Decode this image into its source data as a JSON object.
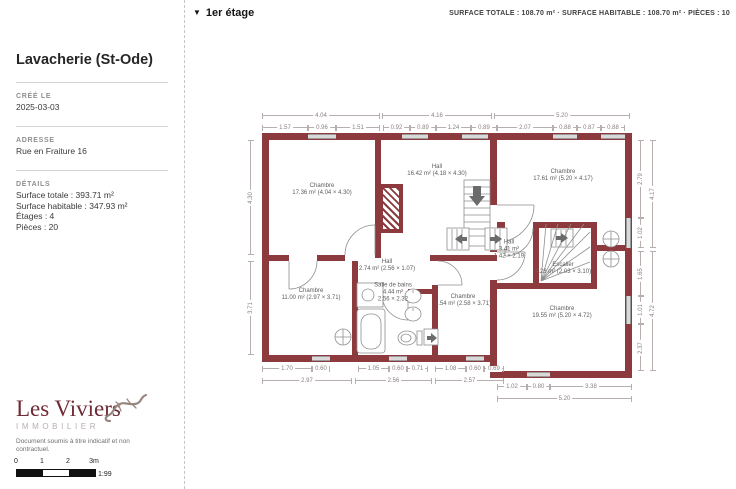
{
  "header": {
    "triangle": "▼",
    "floor_label": "1er étage",
    "surface_summary": "SURFACE TOTALE : 108.70 m² · SURFACE HABITABLE : 108.70 m² · PIÈCES : 10"
  },
  "sidebar": {
    "title": "Lavacherie (St-Ode)",
    "created_label": "CRÉÉ LE",
    "created_value": "2025-03-03",
    "address_label": "ADRESSE",
    "address_value": "Rue en Fraiture 16",
    "details_label": "DÉTAILS",
    "details": [
      "Surface totale : 393.71 m²",
      "Surface habitable : 347.93 m²",
      "Étages : 4",
      "Pièces : 20"
    ],
    "logo_title": "Les Viviers",
    "logo_subtitle": "IMMOBILIER",
    "disclaimer": "Document soumis à titre indicatif et non contractuel.",
    "scale": {
      "ticks": [
        "0",
        "1",
        "2",
        "3m"
      ],
      "ratio": "1:99"
    }
  },
  "plan": {
    "colors": {
      "wall": "#8d3a3e",
      "window": "#d9d9d9"
    },
    "rooms": [
      {
        "lines": [
          "Chambre",
          "17.36 m² (4.04 × 4.30)"
        ],
        "cx": 322,
        "cy": 190
      },
      {
        "lines": [
          "Hall",
          "16.42 m² (4.18 × 4.30)"
        ],
        "cx": 437,
        "cy": 171
      },
      {
        "lines": [
          "Chambre",
          "17.61 m² (5.20 × 4.17)"
        ],
        "cx": 563,
        "cy": 176
      },
      {
        "lines": [
          "Chambre",
          "11.00 m² (2.97 × 3.71)"
        ],
        "cx": 311,
        "cy": 295
      },
      {
        "lines": [
          "Hall",
          "2.74 m² (2.56 × 1.07)"
        ],
        "cx": 387,
        "cy": 266
      },
      {
        "lines": [
          "Salle de bains",
          "4.44 m²",
          "2.56 × 2.32"
        ],
        "cx": 393,
        "cy": 293
      },
      {
        "lines": [
          "Chambre",
          "9.54 m² (2.58 × 3.71)"
        ],
        "cx": 463,
        "cy": 301
      },
      {
        "lines": [
          "Hall",
          "3.41 m²",
          "1.42 × 2.19"
        ],
        "cx": 509,
        "cy": 250
      },
      {
        "lines": [
          "Escalier",
          "4.28 m² (2.03 × 3.10)"
        ],
        "cx": 563,
        "cy": 269
      },
      {
        "lines": [
          "Chambre",
          "19.55 m² (5.20 × 4.72)"
        ],
        "cx": 562,
        "cy": 313
      }
    ],
    "dims_h": [
      {
        "label": "4.04",
        "x": 262,
        "y": 115,
        "w": 118
      },
      {
        "label": "4.16",
        "x": 382,
        "y": 115,
        "w": 110
      },
      {
        "label": "5.20",
        "x": 494,
        "y": 115,
        "w": 136
      },
      {
        "label": "1.57",
        "x": 262,
        "y": 127,
        "w": 46
      },
      {
        "label": "0.96",
        "x": 308,
        "y": 127,
        "w": 28
      },
      {
        "label": "1.51",
        "x": 336,
        "y": 127,
        "w": 44
      },
      {
        "label": "0.92",
        "x": 383,
        "y": 127,
        "w": 27
      },
      {
        "label": "0.89",
        "x": 410,
        "y": 127,
        "w": 26
      },
      {
        "label": "1.24",
        "x": 436,
        "y": 127,
        "w": 35
      },
      {
        "label": "0.89",
        "x": 471,
        "y": 127,
        "w": 26
      },
      {
        "label": "2.07",
        "x": 497,
        "y": 127,
        "w": 56
      },
      {
        "label": "0.88",
        "x": 553,
        "y": 127,
        "w": 24
      },
      {
        "label": "0.87",
        "x": 577,
        "y": 127,
        "w": 24
      },
      {
        "label": "0.88",
        "x": 601,
        "y": 127,
        "w": 24
      },
      {
        "label": "1.70",
        "x": 262,
        "y": 368,
        "w": 50
      },
      {
        "label": "0.60",
        "x": 312,
        "y": 368,
        "w": 18
      },
      {
        "label": "1.05",
        "x": 358,
        "y": 368,
        "w": 31
      },
      {
        "label": "0.60",
        "x": 389,
        "y": 368,
        "w": 18
      },
      {
        "label": "0.71",
        "x": 407,
        "y": 368,
        "w": 21
      },
      {
        "label": "1.08",
        "x": 435,
        "y": 368,
        "w": 31
      },
      {
        "label": "0.60",
        "x": 466,
        "y": 368,
        "w": 18
      },
      {
        "label": "0.69",
        "x": 484,
        "y": 368,
        "w": 20
      },
      {
        "label": "2.97",
        "x": 262,
        "y": 380,
        "w": 90
      },
      {
        "label": "2.56",
        "x": 355,
        "y": 380,
        "w": 77
      },
      {
        "label": "2.57",
        "x": 435,
        "y": 380,
        "w": 69
      },
      {
        "label": "1.02",
        "x": 497,
        "y": 386,
        "w": 30
      },
      {
        "label": "0.80",
        "x": 527,
        "y": 386,
        "w": 23
      },
      {
        "label": "3.38",
        "x": 550,
        "y": 386,
        "w": 82
      },
      {
        "label": "5.20",
        "x": 497,
        "y": 398,
        "w": 135
      }
    ],
    "dims_v": [
      {
        "label": "4.30",
        "x": 250,
        "y": 140,
        "h": 115
      },
      {
        "label": "3.71",
        "x": 250,
        "y": 261,
        "h": 94
      },
      {
        "label": "2.79",
        "x": 640,
        "y": 140,
        "h": 78
      },
      {
        "label": "1.02",
        "x": 640,
        "y": 218,
        "h": 30
      },
      {
        "label": "1.65",
        "x": 640,
        "y": 251,
        "h": 45
      },
      {
        "label": "1.01",
        "x": 640,
        "y": 296,
        "h": 28
      },
      {
        "label": "2.37",
        "x": 640,
        "y": 324,
        "h": 47
      },
      {
        "label": "4.17",
        "x": 652,
        "y": 140,
        "h": 108
      },
      {
        "label": "4.72",
        "x": 652,
        "y": 251,
        "h": 120
      }
    ]
  }
}
